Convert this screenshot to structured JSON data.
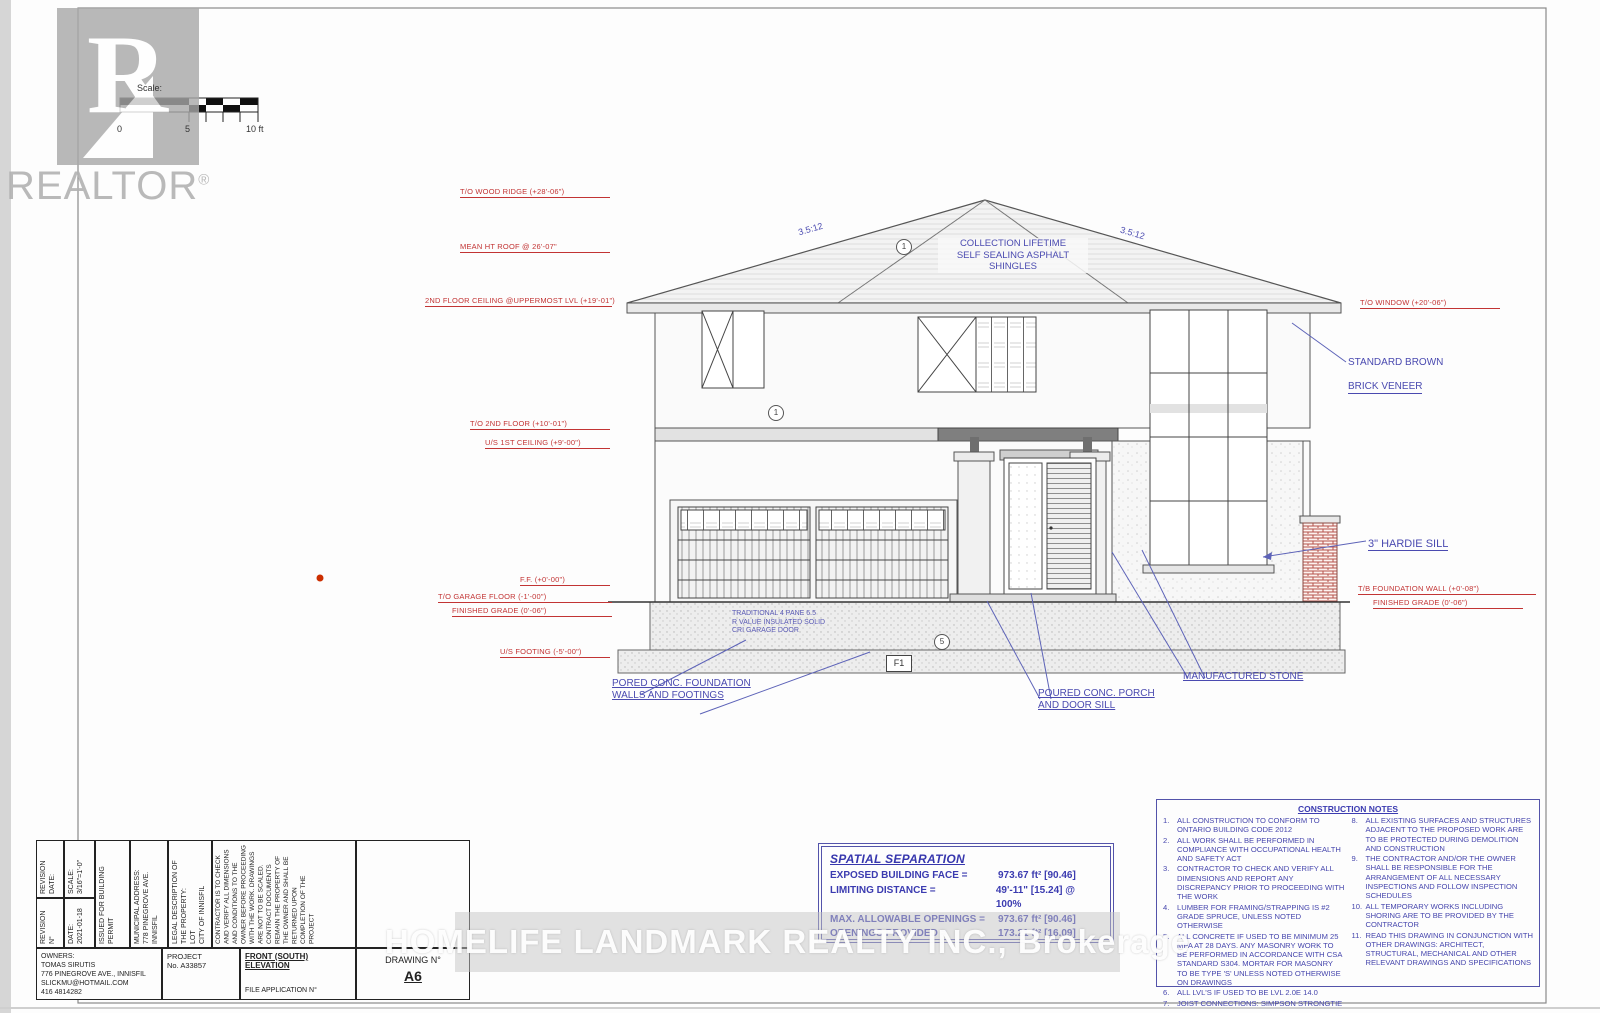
{
  "branding": {
    "wordmark": "REALTOR",
    "reg": "®",
    "watermark": "HOMELIFE LANDMARK REALTY INC.,  Brokerage"
  },
  "scale_bar": {
    "label": "Scale:",
    "tick0": "0",
    "tick5": "5",
    "tick10": "10 ft"
  },
  "roof": {
    "note_lines": [
      "COLLECTION LIFETIME",
      "SELF SEALING ASPHALT",
      "SHINGLES"
    ],
    "slope_left": "3.5:12",
    "slope_right": "3.5:12"
  },
  "elevation_left": [
    "T/O WOOD RIDGE (+28'-06\")",
    "MEAN HT ROOF @ 26'-07\"",
    "2ND FLOOR CEILING @UPPERMOST LVL (+19'-01\")",
    "T/O 2ND FLOOR (+10'-01\")",
    "U/S 1ST CEILING (+9'-00\")",
    "F.F. (+0'-00\")",
    "T/O GARAGE FLOOR (-1'-00\")",
    "FINISHED GRADE (0'-06\")",
    "U/S FOOTING (-5'-00\")"
  ],
  "elevation_right": [
    "T/O WINDOW (+20'-06\")",
    "T/B FOUNDATION WALL (+0'-08\")",
    "FINISHED GRADE (0'-06\")"
  ],
  "callouts": {
    "brick_1": "STANDARD BROWN",
    "brick_2": "BRICK VENEER",
    "hardie": "3\" HARDIE SILL",
    "garage": "TRADITIONAL 4 PANE 6.5\nR VALUE INSULATED SOLID\nCRI GARAGE DOOR",
    "foundation": "PORED CONC. FOUNDATION\nWALLS AND FOOTINGS",
    "porch": "POURED CONC. PORCH\nAND DOOR SILL",
    "stone": "MANUFACTURED STONE"
  },
  "markers": {
    "f1": "F1",
    "c1": "1",
    "c2": "1",
    "c3": "5"
  },
  "spatial_separation": {
    "title": "SPATIAL SEPARATION",
    "rows": [
      {
        "label": "EXPOSED BUILDING FACE =",
        "value": "973.67 ft² [90.46]"
      },
      {
        "label": "LIMITING DISTANCE =",
        "value": "49'-11\" [15.24] @ 100%"
      },
      {
        "label": "MAX. ALLOWABLE OPENINGS =",
        "value": "973.67 ft² [90.46]"
      },
      {
        "label": "OPENINGS PROVIDED =",
        "value": "173.21 ft² [16.09]"
      }
    ]
  },
  "construction_notes": {
    "title": "CONSTRUCTION NOTES",
    "left": [
      {
        "n": "1.",
        "t": "ALL CONSTRUCTION TO CONFORM TO ONTARIO BUILDING CODE 2012"
      },
      {
        "n": "2.",
        "t": "ALL WORK SHALL BE PERFORMED IN COMPLIANCE WITH OCCUPATIONAL HEALTH AND SAFETY ACT"
      },
      {
        "n": "3.",
        "t": "CONTRACTOR TO CHECK AND VERIFY ALL DIMENSIONS AND REPORT ANY DISCREPANCY PRIOR TO PROCEEDING WITH THE WORK"
      },
      {
        "n": "4.",
        "t": "LUMBER FOR FRAMING/STRAPPING IS #2 GRADE SPRUCE, UNLESS NOTED OTHERWISE"
      },
      {
        "n": "5.",
        "t": "ALL CONCRETE IF USED TO BE MINIMUM 25 MPA AT 28 DAYS. ANY MASONRY WORK TO BE PERFORMED IN ACCORDANCE WITH CSA STANDARD S304. MORTAR FOR MASONRY TO BE TYPE 'S' UNLESS NOTED OTHERWISE ON DRAWINGS"
      },
      {
        "n": "6.",
        "t": "ALL LVL'S IF USED TO BE LVL 2.0E 14.0"
      },
      {
        "n": "7.",
        "t": "JOIST CONNECTIONS: SIMPSON STRONGTIE"
      }
    ],
    "right": [
      {
        "n": "8.",
        "t": "ALL EXISTING SURFACES AND STRUCTURES ADJACENT TO THE PROPOSED WORK ARE TO BE PROTECTED DURING DEMOLITION AND CONSTRUCTION"
      },
      {
        "n": "9.",
        "t": "THE CONTRACTOR AND/OR THE OWNER SHALL BE RESPONSIBLE FOR THE ARRANGEMENT OF ALL NECESSARY INSPECTIONS AND FOLLOW INSPECTION SCHEDULES"
      },
      {
        "n": "10.",
        "t": "ALL TEMPORARY WORKS INCLUDING SHORING ARE TO BE PROVIDED BY THE CONTRACTOR"
      },
      {
        "n": "11.",
        "t": "READ THIS DRAWING IN CONJUNCTION WITH OTHER DRAWINGS: ARCHITECT, STRUCTURAL, MECHANICAL AND OTHER RELEVANT DRAWINGS AND SPECIFICATIONS"
      }
    ]
  },
  "title_block": {
    "revision_date": "REVISION\nDATE:",
    "revision_no": "REVISION N°",
    "scale": "SCALE:\n3/16\"=1'-0\"",
    "date": "DATE:\n2021-01-18",
    "issued": "ISSUED FOR BUILDING\nPERMIT",
    "municipal": "MUNICIPAL ADDRESS:\n778 PINEGROVE AVE.\nINNISFIL",
    "legal": "LEGAL DESCRIPTION OF\nTHE PROPERTY:\nLOT\nCITY OF INNISFIL",
    "disclaimer": "CONTRACTOR IS TO CHECK AND VERIFY ALL DIMENSIONS AND CONDITIONS TO THE OWNER BEFORE PROCEEDING WITH THE WORK. DRAWINGS ARE NOT TO BE SCALED. CONTRACT DOCUMENTS REMAIN THE PROPERTY OF THE OWNER AND SHALL BE RETURNED UPON COMPLETION OF THE PROJECT",
    "owners": "OWNERS:\nTOMAS SIRUTIS\n776 PINEGROVE AVE., INNISFIL\nSLICKMU@HOTMAIL.COM\n416 4814282",
    "project": "PROJECT\nNo. A33857",
    "sheet_title": "FRONT (SOUTH) ELEVATION",
    "file_application": "FILE APPLICATION N°",
    "drawing_no_label": "DRAWING N°",
    "drawing_no": "A6"
  }
}
